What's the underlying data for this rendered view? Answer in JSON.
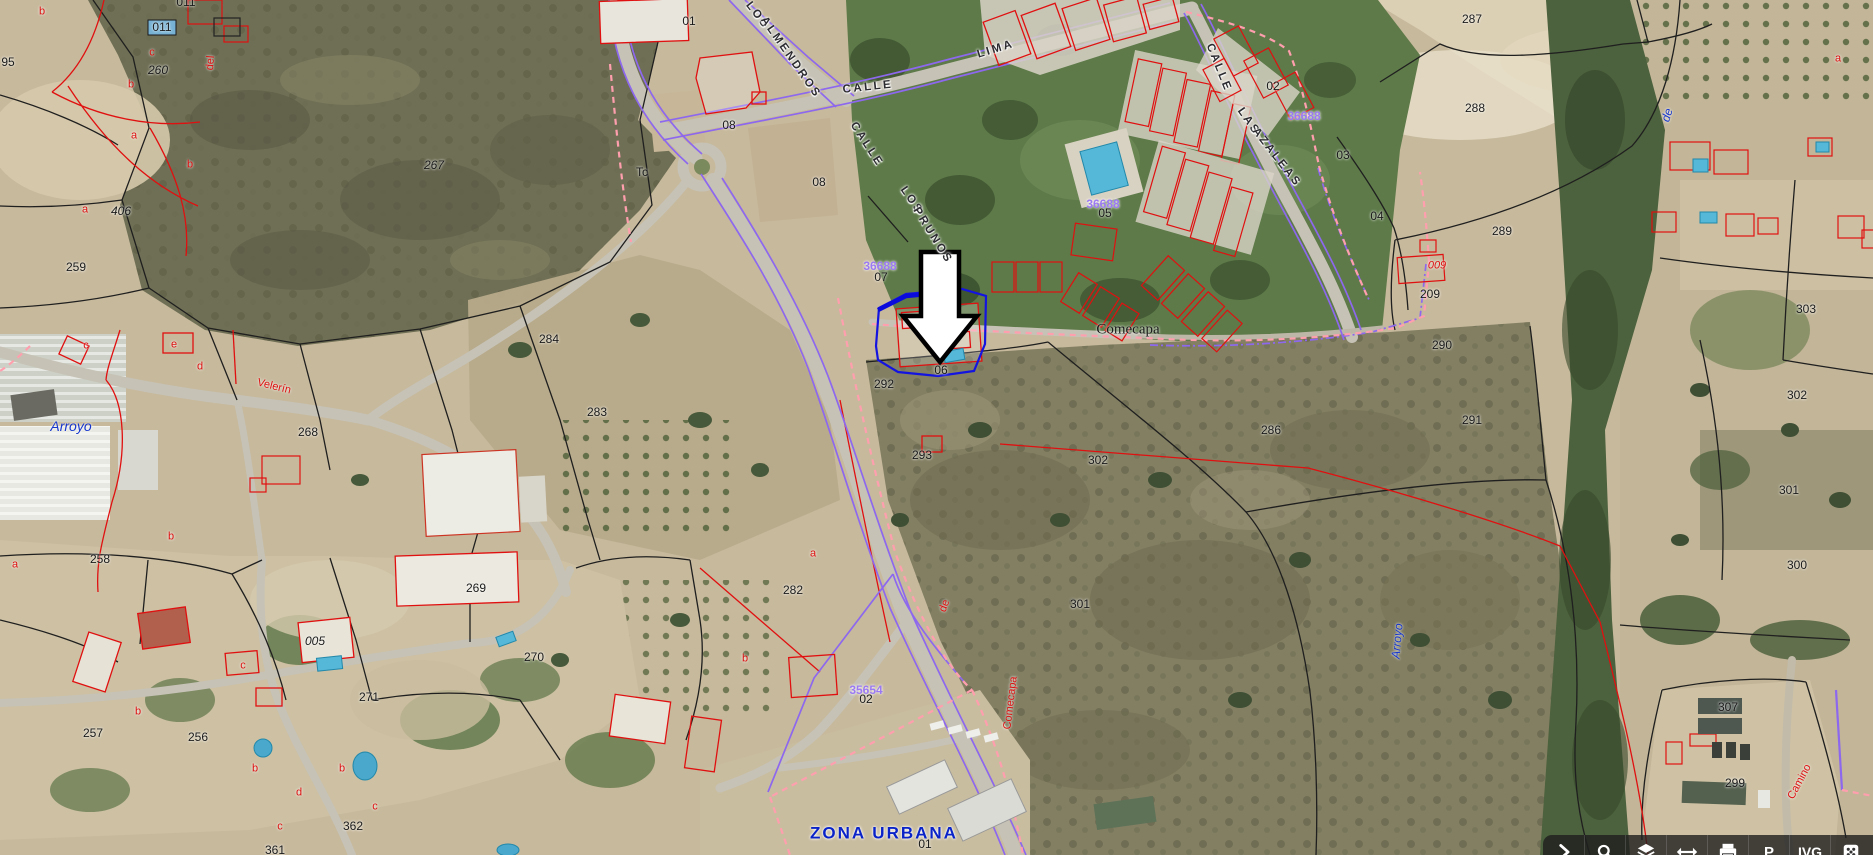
{
  "map": {
    "selection": {
      "parcel_label": "06"
    },
    "labels": [
      {
        "t": "CALLE",
        "x": 868,
        "y": 88,
        "cls": "street",
        "r": -6,
        "n": "street-name-label"
      },
      {
        "t": "LIMA",
        "x": 996,
        "y": 50,
        "cls": "street",
        "r": -17,
        "n": "street-name-label"
      },
      {
        "t": "LOS",
        "x": 757,
        "y": 16,
        "cls": "street",
        "r": 52,
        "n": "street-name-label"
      },
      {
        "t": "ALMENDROS",
        "x": 790,
        "y": 58,
        "cls": "street",
        "r": 55,
        "n": "street-name-label"
      },
      {
        "t": "CALLE",
        "x": 866,
        "y": 145,
        "cls": "street",
        "r": 57,
        "n": "street-name-label"
      },
      {
        "t": "LOS",
        "x": 911,
        "y": 201,
        "cls": "street",
        "r": 55,
        "n": "street-name-label"
      },
      {
        "t": "PRUNOS",
        "x": 932,
        "y": 236,
        "cls": "street",
        "r": 58,
        "n": "street-name-label"
      },
      {
        "t": "CALLE",
        "x": 1218,
        "y": 68,
        "cls": "street",
        "r": 68,
        "n": "street-name-label"
      },
      {
        "t": "LAS",
        "x": 1248,
        "y": 122,
        "cls": "street",
        "r": 55,
        "n": "street-name-label"
      },
      {
        "t": "AZALEAS",
        "x": 1276,
        "y": 158,
        "cls": "street",
        "r": 52,
        "n": "street-name-label"
      },
      {
        "t": "Arroyo",
        "x": 71,
        "y": 426,
        "c": "bl",
        "s": 14,
        "i": 1,
        "n": "toponym-label"
      },
      {
        "t": "Arroyo",
        "x": 1397,
        "y": 641,
        "c": "bl",
        "s": 12,
        "i": 1,
        "r": -85,
        "n": "toponym-label"
      },
      {
        "t": "de",
        "x": 1667,
        "y": 115,
        "c": "bl",
        "s": 12,
        "i": 1,
        "r": -72,
        "n": "toponym-label"
      },
      {
        "t": "ZONA URBANA",
        "x": 884,
        "y": 833,
        "c": "zb",
        "s": 17,
        "b": 1,
        "cls": "zona",
        "n": "zone-label"
      },
      {
        "t": "36688",
        "x": 880,
        "y": 266,
        "c": "pu",
        "s": 12,
        "b": 1,
        "n": "block-id-label"
      },
      {
        "t": "36688",
        "x": 1103,
        "y": 204,
        "c": "pu",
        "s": 12,
        "b": 1,
        "n": "block-id-label"
      },
      {
        "t": "36688",
        "x": 1304,
        "y": 116,
        "c": "pu",
        "s": 12,
        "b": 1,
        "n": "block-id-label"
      },
      {
        "t": "35654",
        "x": 866,
        "y": 690,
        "c": "pu",
        "s": 12,
        "b": 1,
        "n": "block-id-label"
      },
      {
        "t": "Comecapa",
        "x": 1128,
        "y": 330,
        "s": 15,
        "cls": "serif",
        "n": "toponym-label"
      },
      {
        "t": "287",
        "x": 1472,
        "y": 19,
        "n": "parcel-number-label"
      },
      {
        "t": "288",
        "x": 1475,
        "y": 108,
        "n": "parcel-number-label"
      },
      {
        "t": "289",
        "x": 1502,
        "y": 231,
        "n": "parcel-number-label"
      },
      {
        "t": "267",
        "x": 434,
        "y": 165,
        "i": 1,
        "n": "parcel-number-label"
      },
      {
        "t": "260",
        "x": 158,
        "y": 70,
        "i": 1,
        "n": "parcel-number-label"
      },
      {
        "t": "406",
        "x": 121,
        "y": 211,
        "i": 1,
        "n": "parcel-number-label"
      },
      {
        "t": "259",
        "x": 76,
        "y": 267,
        "n": "parcel-number-label"
      },
      {
        "t": "95",
        "x": 8,
        "y": 62,
        "n": "parcel-number-label"
      },
      {
        "t": "011",
        "x": 162,
        "y": 27,
        "n": "parcel-number-label"
      },
      {
        "t": "011",
        "x": 186,
        "y": 2,
        "n": "parcel-number-label"
      },
      {
        "t": "258",
        "x": 100,
        "y": 559,
        "n": "parcel-number-label"
      },
      {
        "t": "257",
        "x": 93,
        "y": 733,
        "n": "parcel-number-label"
      },
      {
        "t": "256",
        "x": 198,
        "y": 737,
        "n": "parcel-number-label"
      },
      {
        "t": "268",
        "x": 308,
        "y": 432,
        "n": "parcel-number-label"
      },
      {
        "t": "269",
        "x": 476,
        "y": 588,
        "n": "parcel-number-label"
      },
      {
        "t": "270",
        "x": 534,
        "y": 657,
        "n": "parcel-number-label"
      },
      {
        "t": "271",
        "x": 369,
        "y": 697,
        "n": "parcel-number-label"
      },
      {
        "t": "362",
        "x": 353,
        "y": 826,
        "n": "parcel-number-label"
      },
      {
        "t": "361",
        "x": 275,
        "y": 850,
        "n": "parcel-number-label"
      },
      {
        "t": "005",
        "x": 315,
        "y": 641,
        "i": 1,
        "n": "parcel-number-label"
      },
      {
        "t": "284",
        "x": 549,
        "y": 339,
        "n": "parcel-number-label"
      },
      {
        "t": "283",
        "x": 597,
        "y": 412,
        "n": "parcel-number-label"
      },
      {
        "t": "282",
        "x": 793,
        "y": 590,
        "n": "parcel-number-label"
      },
      {
        "t": "08",
        "x": 819,
        "y": 182,
        "n": "parcel-number-label"
      },
      {
        "t": "08",
        "x": 729,
        "y": 125,
        "n": "parcel-number-label"
      },
      {
        "t": "Tc",
        "x": 642,
        "y": 172,
        "n": "parcel-number-label"
      },
      {
        "t": "01",
        "x": 689,
        "y": 21,
        "n": "parcel-number-label"
      },
      {
        "t": "07",
        "x": 881,
        "y": 277,
        "n": "parcel-number-label"
      },
      {
        "t": "06",
        "x": 941,
        "y": 370,
        "n": "parcel-number-label"
      },
      {
        "t": "05",
        "x": 1105,
        "y": 213,
        "n": "parcel-number-label"
      },
      {
        "t": "02",
        "x": 1273,
        "y": 86,
        "n": "parcel-number-label"
      },
      {
        "t": "03",
        "x": 1343,
        "y": 155,
        "n": "parcel-number-label"
      },
      {
        "t": "04",
        "x": 1377,
        "y": 216,
        "n": "parcel-number-label"
      },
      {
        "t": "009",
        "x": 1437,
        "y": 266,
        "c": "r",
        "i": 1,
        "s": 11,
        "n": "parcel-number-label"
      },
      {
        "t": "209",
        "x": 1430,
        "y": 294,
        "n": "parcel-number-label"
      },
      {
        "t": "290",
        "x": 1442,
        "y": 345,
        "n": "parcel-number-label"
      },
      {
        "t": "291",
        "x": 1472,
        "y": 420,
        "n": "parcel-number-label"
      },
      {
        "t": "286",
        "x": 1271,
        "y": 430,
        "n": "parcel-number-label"
      },
      {
        "t": "292",
        "x": 884,
        "y": 384,
        "n": "parcel-number-label"
      },
      {
        "t": "293",
        "x": 922,
        "y": 455,
        "n": "parcel-number-label"
      },
      {
        "t": "302",
        "x": 1098,
        "y": 460,
        "n": "parcel-number-label"
      },
      {
        "t": "301",
        "x": 1080,
        "y": 604,
        "n": "parcel-number-label"
      },
      {
        "t": "303",
        "x": 1806,
        "y": 309,
        "n": "parcel-number-label"
      },
      {
        "t": "302",
        "x": 1797,
        "y": 395,
        "n": "parcel-number-label"
      },
      {
        "t": "301",
        "x": 1789,
        "y": 490,
        "n": "parcel-number-label"
      },
      {
        "t": "300",
        "x": 1797,
        "y": 565,
        "n": "parcel-number-label"
      },
      {
        "t": "307",
        "x": 1728,
        "y": 707,
        "n": "parcel-number-label"
      },
      {
        "t": "299",
        "x": 1735,
        "y": 783,
        "n": "parcel-number-label"
      },
      {
        "t": "02",
        "x": 866,
        "y": 699,
        "n": "parcel-number-label"
      },
      {
        "t": "01",
        "x": 925,
        "y": 844,
        "n": "parcel-number-label"
      },
      {
        "t": "Velerín",
        "x": 274,
        "y": 387,
        "c": "r",
        "s": 11,
        "r": 14,
        "n": "camino-name-label"
      },
      {
        "t": "del",
        "x": 211,
        "y": 63,
        "c": "r",
        "s": 11,
        "r": -85,
        "n": "camino-name-label"
      },
      {
        "t": "de",
        "x": 945,
        "y": 606,
        "c": "r",
        "s": 11,
        "r": -70,
        "n": "camino-name-label"
      },
      {
        "t": "Comecapa",
        "x": 1011,
        "y": 703,
        "c": "r",
        "s": 11,
        "r": -83,
        "n": "camino-name-label"
      },
      {
        "t": "Camino",
        "x": 1800,
        "y": 782,
        "c": "r",
        "s": 11,
        "r": -62,
        "n": "camino-name-label"
      },
      {
        "t": "a",
        "x": 15,
        "y": 565,
        "c": "r",
        "s": 11,
        "n": "subparcel-letter-label"
      },
      {
        "t": "b",
        "x": 171,
        "y": 537,
        "c": "r",
        "s": 11,
        "n": "subparcel-letter-label"
      },
      {
        "t": "c",
        "x": 86,
        "y": 346,
        "c": "r",
        "s": 11,
        "n": "subparcel-letter-label"
      },
      {
        "t": "e",
        "x": 174,
        "y": 345,
        "c": "r",
        "s": 11,
        "n": "subparcel-letter-label"
      },
      {
        "t": "d",
        "x": 200,
        "y": 367,
        "c": "r",
        "s": 11,
        "n": "subparcel-letter-label"
      },
      {
        "t": "a",
        "x": 85,
        "y": 210,
        "c": "r",
        "s": 11,
        "n": "subparcel-letter-label"
      },
      {
        "t": "b",
        "x": 190,
        "y": 165,
        "c": "r",
        "s": 11,
        "n": "subparcel-letter-label"
      },
      {
        "t": "a",
        "x": 134,
        "y": 136,
        "c": "r",
        "s": 11,
        "n": "subparcel-letter-label"
      },
      {
        "t": "b",
        "x": 131,
        "y": 85,
        "c": "r",
        "s": 11,
        "n": "subparcel-letter-label"
      },
      {
        "t": "c",
        "x": 152,
        "y": 53,
        "c": "r",
        "s": 11,
        "n": "subparcel-letter-label"
      },
      {
        "t": "b",
        "x": 42,
        "y": 12,
        "c": "r",
        "s": 11,
        "n": "subparcel-letter-label"
      },
      {
        "t": "a",
        "x": 1838,
        "y": 59,
        "c": "r",
        "s": 11,
        "n": "subparcel-letter-label"
      },
      {
        "t": "c",
        "x": 243,
        "y": 666,
        "c": "r",
        "s": 11,
        "n": "subparcel-letter-label"
      },
      {
        "t": "b",
        "x": 138,
        "y": 712,
        "c": "r",
        "s": 11,
        "n": "subparcel-letter-label"
      },
      {
        "t": "b",
        "x": 255,
        "y": 769,
        "c": "r",
        "s": 11,
        "n": "subparcel-letter-label"
      },
      {
        "t": "d",
        "x": 299,
        "y": 793,
        "c": "r",
        "s": 11,
        "n": "subparcel-letter-label"
      },
      {
        "t": "b",
        "x": 342,
        "y": 769,
        "c": "r",
        "s": 11,
        "n": "subparcel-letter-label"
      },
      {
        "t": "c",
        "x": 280,
        "y": 827,
        "c": "r",
        "s": 11,
        "n": "subparcel-letter-label"
      },
      {
        "t": "c",
        "x": 375,
        "y": 807,
        "c": "r",
        "s": 11,
        "n": "subparcel-letter-label"
      },
      {
        "t": "a",
        "x": 813,
        "y": 554,
        "c": "r",
        "s": 11,
        "n": "subparcel-letter-label"
      },
      {
        "t": "b",
        "x": 745,
        "y": 659,
        "c": "r",
        "s": 11,
        "n": "subparcel-letter-label"
      }
    ]
  },
  "toolbar": {
    "p_label": "P",
    "ivg_label": "IVG",
    "buttons": [
      "expand",
      "search",
      "layers",
      "measure",
      "print",
      "point-info",
      "ivg",
      "dice"
    ]
  }
}
